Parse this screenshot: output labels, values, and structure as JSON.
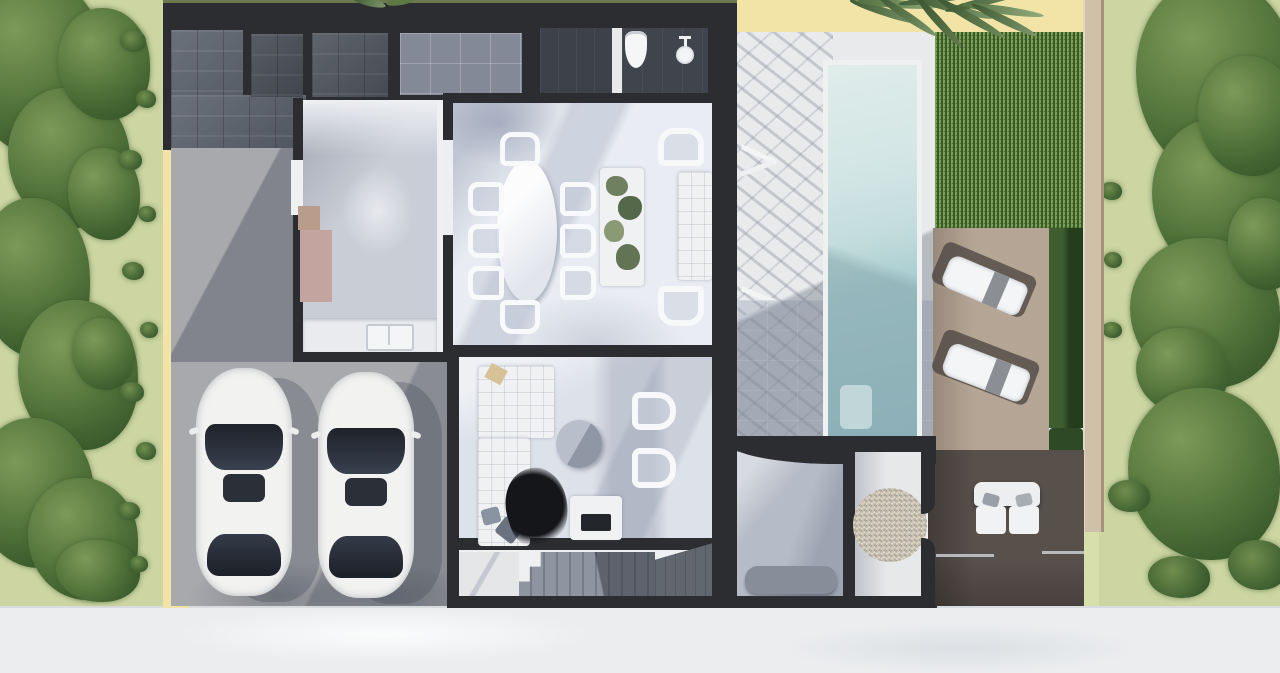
{
  "scene": {
    "type": "architectural-floorplan-3d-render",
    "view": "top-down aerial",
    "label": "Villa floor plan render with pool, double carport and gardens"
  },
  "palette": {
    "wall_charcoal": "#2b2d30",
    "slate_tile": "#5a616c",
    "glass_roof": "#838996",
    "driveway_gray": "#a8a9ad",
    "floor_white": "#e9ecf2",
    "floor_cool_gray": "#c9cdd6",
    "entry_tile": "#b6bcc7",
    "pool_light": "#d8e9e8",
    "pool_deep": "#9cc2c9",
    "lawn_green": "#7ba155",
    "lawn_shadow": "#26471d",
    "deck_light_wood": "#b5a594",
    "deck_dark_wood": "#58504b",
    "cream_wall": "#f2e4a7",
    "tan_wall": "#cfc0aa",
    "garden_ground": "#cdd6a3",
    "foliage_green": "#4e7038",
    "street_white": "#ebedef",
    "car_white": "#f2f2f1",
    "gravel_tan": "#c9bfae",
    "pink_cabinet": "#c4a49e"
  },
  "rooms": [
    {
      "id": "driveway",
      "label": "Driveway carport with two cars"
    },
    {
      "id": "kitchen",
      "label": "Kitchen with counter and sink"
    },
    {
      "id": "dining",
      "label": "Dining room, oval table for eight"
    },
    {
      "id": "living",
      "label": "Living room with L-sofa and TV"
    },
    {
      "id": "bathroom",
      "label": "Bathroom with toilet and basin"
    },
    {
      "id": "shower",
      "label": "Shower room"
    },
    {
      "id": "stairs",
      "label": "Staircase"
    },
    {
      "id": "entry",
      "label": "Entry hall with curved wall and bench"
    },
    {
      "id": "gravel",
      "label": "Gravel court"
    },
    {
      "id": "pool-terrace",
      "label": "Pool terrace with pergola shadow"
    },
    {
      "id": "pool",
      "label": "Swimming pool"
    },
    {
      "id": "lawn",
      "label": "Back lawn"
    },
    {
      "id": "sun-deck",
      "label": "Sun deck with two loungers"
    },
    {
      "id": "lounge-deck",
      "label": "Rear deck with loveseat"
    },
    {
      "id": "garden-left",
      "label": "Left garden strip"
    },
    {
      "id": "garden-right",
      "label": "Right garden strip"
    },
    {
      "id": "street",
      "label": "Street / sidewalk"
    },
    {
      "id": "roof-patios",
      "label": "Slate roof patios"
    }
  ],
  "counts": {
    "cars": 2,
    "sun_loungers": 2,
    "dining_side_chairs": 8,
    "dining_armchairs": 2,
    "living_armchairs": 2,
    "palm_trees": 1
  }
}
